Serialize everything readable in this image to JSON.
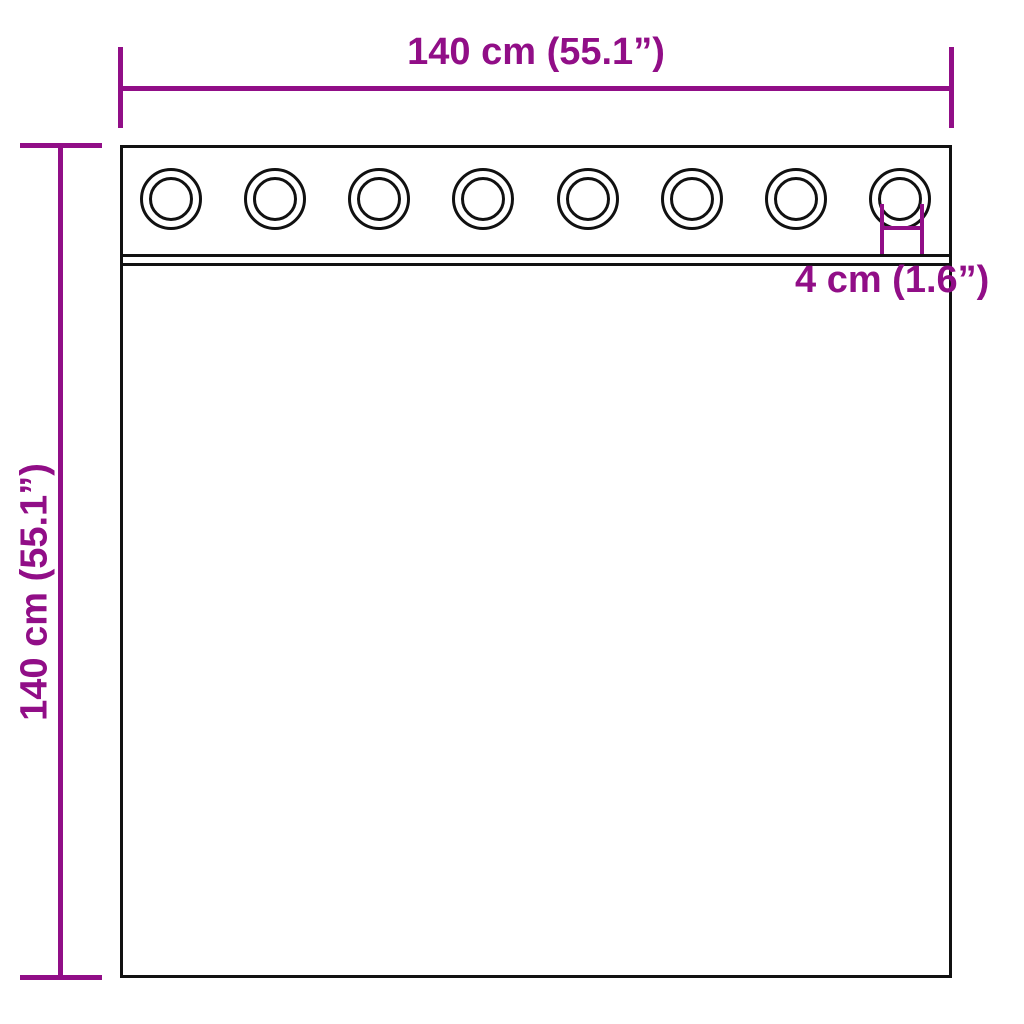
{
  "diagram": {
    "title": "curtain-with-grommets-dimension-diagram",
    "background_color": "#ffffff",
    "accent_color": "#910e87",
    "line_color": "#111111",
    "width_dimension": {
      "label": "140 cm (55.1”)",
      "value_cm": 140,
      "value_inch": 55.1
    },
    "height_dimension": {
      "label": "140 cm (55.1”)",
      "value_cm": 140,
      "value_inch": 55.1
    },
    "grommet_dimension": {
      "label": "4 cm (1.6”)",
      "value_cm": 4,
      "value_inch": 1.6
    },
    "grommets": {
      "count": 8,
      "first_center_x": 171,
      "last_center_x": 900,
      "center_y": 199
    }
  }
}
